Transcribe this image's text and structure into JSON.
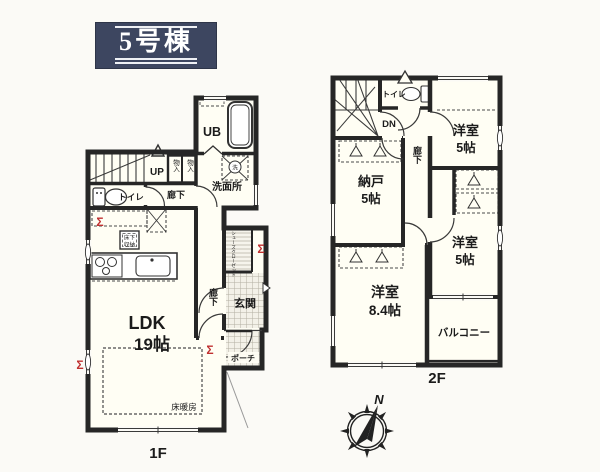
{
  "badge": {
    "title": "5号棟"
  },
  "colors": {
    "badge_bg": "#3d4660",
    "wall": "#262626",
    "room_fill": "#fffef4",
    "hatch_line": "#b3afa2",
    "accent_red": "#c03030"
  },
  "floor1": {
    "label": "1F",
    "ldk_name": "LDK",
    "ldk_size": "19帖",
    "floor_heating": "床暖房",
    "underfloor_l1": "床下",
    "underfloor_l2": "収納",
    "toilet": "トイレ",
    "hall_upper": "廊下",
    "hall_lower": "廊下",
    "stairs": "UP",
    "unit_bath": "UB",
    "washroom": "洗面所",
    "closet1": "物入",
    "closet2": "物入",
    "washer": "洗",
    "shoes_closet": "シューズクローゼット",
    "entrance": "玄関",
    "porch": "ポーチ",
    "shutter": "Σ"
  },
  "floor2": {
    "label": "2F",
    "toilet": "トイレ",
    "stairs": "DN",
    "hall": "廊下",
    "bedroom_top_name": "洋室",
    "bedroom_top_size": "5帖",
    "storage_name": "納戸",
    "storage_size": "5帖",
    "bedroom_mid_name": "洋室",
    "bedroom_mid_size": "5帖",
    "bedroom_big_name": "洋室",
    "bedroom_big_size": "8.4帖",
    "balcony": "バルコニー"
  },
  "compass": {
    "north": "N"
  }
}
